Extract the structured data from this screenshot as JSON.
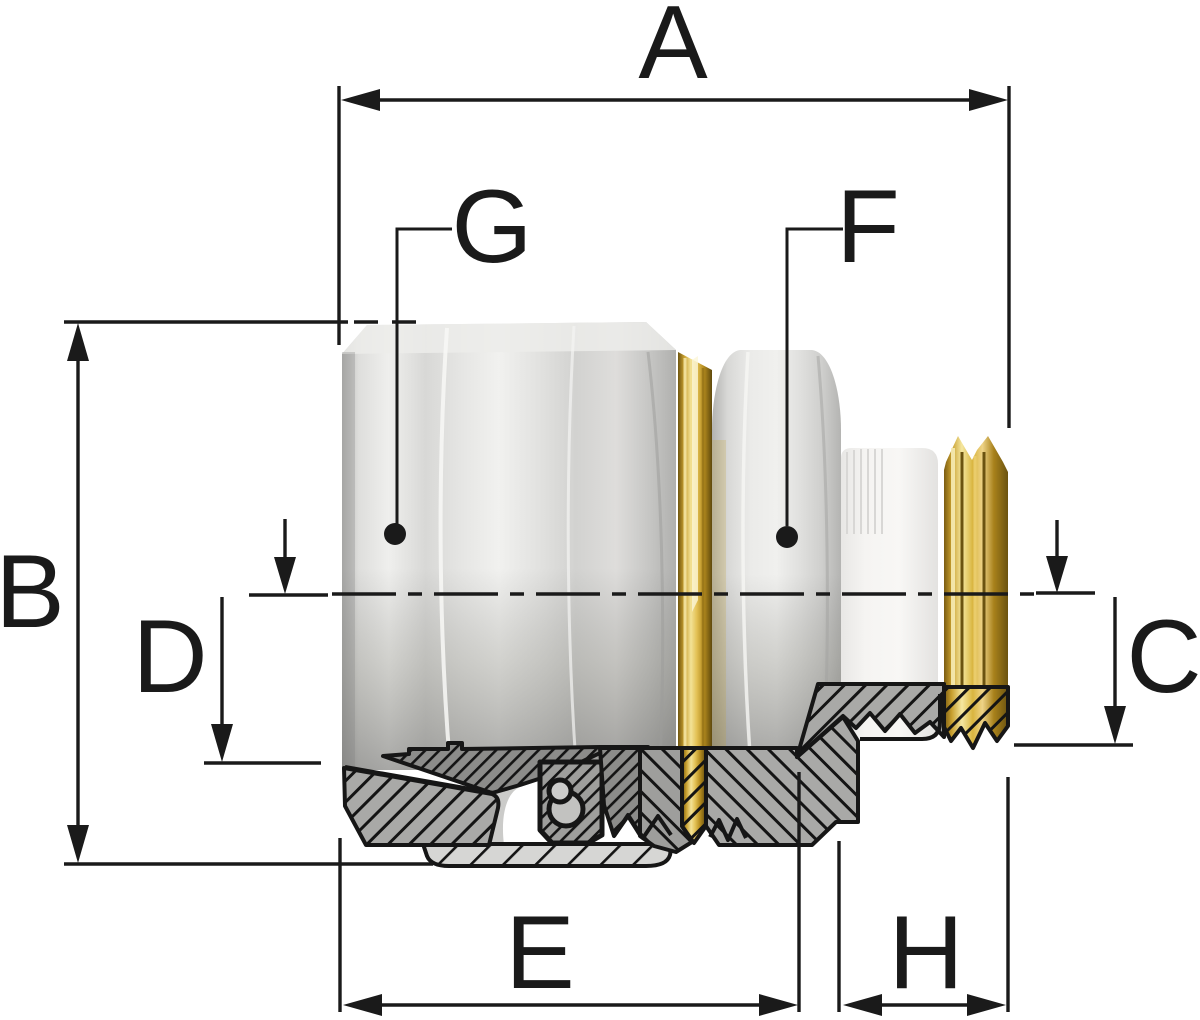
{
  "page": {
    "background": "#ffffff"
  },
  "drawing": {
    "kind": "dimensioned-cross-section-of-compression-pipe-fitting",
    "dimension_labels": {
      "a": "A",
      "b": "B",
      "c": "C",
      "d": "D",
      "e": "E",
      "f": "F",
      "g": "G",
      "h": "H"
    },
    "colors": {
      "line": "#1a1a1a",
      "outline": "#161616",
      "metal_light": "#f1f1ef",
      "metal_mid": "#d6d6d4",
      "metal_shadow": "#a8a8a6",
      "brass": "#c9a42c",
      "brass_highlight": "#f5e7a0",
      "brass_shadow": "#6e5510",
      "collar": "#f2f1ef",
      "section_fill": "#a9a9a7",
      "section_dark": "#8c8c8a",
      "section_body": "#9e9e9c",
      "sleeve": "#d6d6d4",
      "pipe_bore": "#cbcbc9",
      "background": "#ffffff"
    }
  }
}
